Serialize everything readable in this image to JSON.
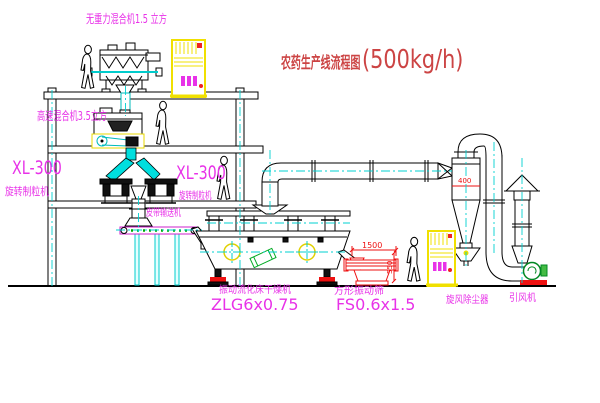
{
  "title": {
    "name_cn": "农药生产线流程图",
    "capacity": "(500kg/h)"
  },
  "labels": {
    "mixer_top": "无重力混合机1.5 立方",
    "mixer_mid": "高速混合机3.5立方",
    "granulator_left_model": "XL-300",
    "granulator_left_name": "旋转制粒机",
    "granulator_right_model": "XL-300",
    "granulator_right_name": "旋转制粒机",
    "belt_conveyor": "皮带输送机",
    "dryer_name": "振动流化床干燥机",
    "dryer_model": "ZLG6x0.75",
    "sieve_name": "方形振动筛",
    "sieve_model": "FS0.6x1.5",
    "cyclone_name": "旋风除尘器",
    "fan_name": "引风机"
  },
  "dimensions": {
    "sieve_length": "1500",
    "cyclone_diameter": "400",
    "sieve_height": "550"
  },
  "colors": {
    "label_magenta": "#e832e8",
    "title_red": "#cc4444",
    "dimension_red": "#ee1111",
    "centerline_cyan": "#00cccc",
    "cabinet_yellow": "#f0e000",
    "highlight_yellow": "#e8d800",
    "motor_green": "#00aa22"
  }
}
